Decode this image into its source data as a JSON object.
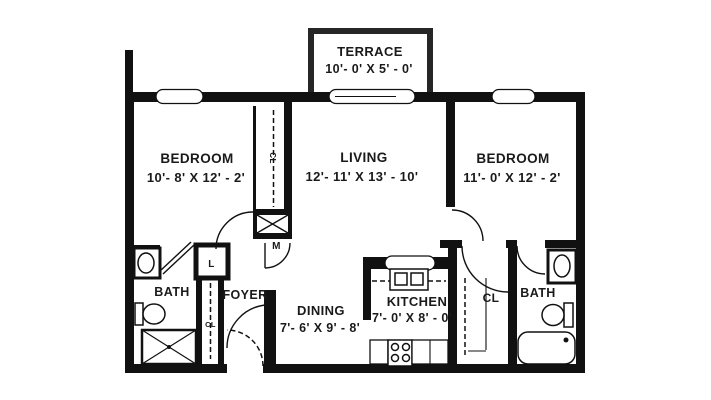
{
  "drawing_type": "apartment-floor-plan",
  "colors": {
    "background": "#ffffff",
    "wall": "#111111",
    "terrace_wall": "#262626",
    "text": "#1a1a1a"
  },
  "rooms": {
    "terrace": {
      "label": "TERRACE",
      "dims": "10'- 0' X 5' - 0'"
    },
    "bedroom_left": {
      "label": "BEDROOM",
      "dims": "10'- 8' X 12' - 2'"
    },
    "living": {
      "label": "LIVING",
      "dims": "12'- 11' X 13' - 10'"
    },
    "bedroom_right": {
      "label": "BEDROOM",
      "dims": "11'- 0' X 12' - 2'"
    },
    "bath_left": {
      "label": "BATH"
    },
    "foyer": {
      "label": "FOYER"
    },
    "dining": {
      "label": "DINING",
      "dims": "7'- 6' X 9' - 8'"
    },
    "kitchen": {
      "label": "KITCHEN",
      "dims": "7'- 0' X 8' - 0'"
    },
    "closet_right": {
      "label": "CL"
    },
    "bath_right": {
      "label": "BATH"
    },
    "closet_hall": {
      "label": "CL"
    },
    "closet_bedroom_left": {
      "label": "CL"
    },
    "linen_closet": {
      "label": "L"
    },
    "mechanical_closet": {
      "label": "M"
    }
  }
}
